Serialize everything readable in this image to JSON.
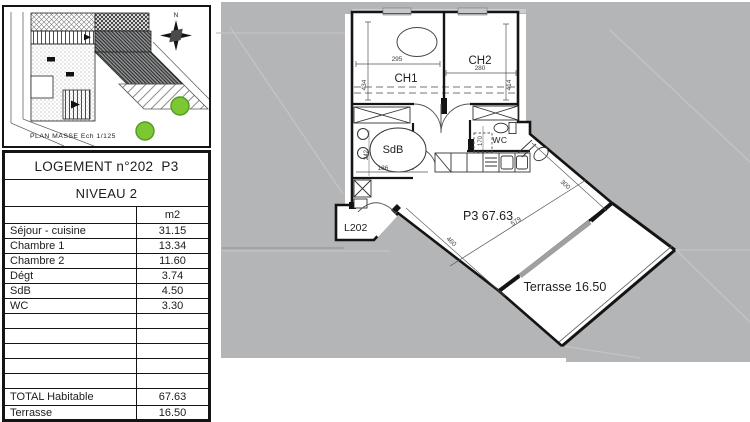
{
  "left_panel": {
    "site_plan": {
      "caption": "PLAN MASSE Ech 1/125",
      "compass_label": "N"
    },
    "table": {
      "title": "LOGEMENT n°202  P3",
      "level": "NIVEAU 2",
      "unit_header": "m2",
      "rows": [
        {
          "label": "Séjour - cuisine",
          "value": "31.15"
        },
        {
          "label": "Chambre 1",
          "value": "13.34"
        },
        {
          "label": "Chambre 2",
          "value": "11.60"
        },
        {
          "label": "Dégt",
          "value": "3.74"
        },
        {
          "label": "SdB",
          "value": "4.50"
        },
        {
          "label": "WC",
          "value": "3.30"
        }
      ],
      "totals": [
        {
          "label": "TOTAL Habitable",
          "value": "67.63"
        },
        {
          "label": "Terrasse",
          "value": "16.50"
        }
      ]
    }
  },
  "floor_plan": {
    "rooms": {
      "ch1": {
        "label": "CH1",
        "width": "295",
        "height": "434"
      },
      "ch2": {
        "label": "CH2",
        "width": "280",
        "height": "414"
      },
      "sdb": {
        "label": "SdB",
        "width": "186",
        "height": "242"
      },
      "wc": {
        "label": "WC",
        "depth": "170"
      },
      "living": {
        "label": "P3 67.63",
        "dim_length": "579",
        "dim_width": "460",
        "dim_side": "300"
      },
      "entrance": {
        "label": "L202"
      },
      "terrace": {
        "label": "Terrasse 16.50"
      }
    },
    "colors": {
      "exterior_gray": "#b4b5b7",
      "wall_black": "#141414",
      "tree_green": "#7cc832"
    }
  }
}
